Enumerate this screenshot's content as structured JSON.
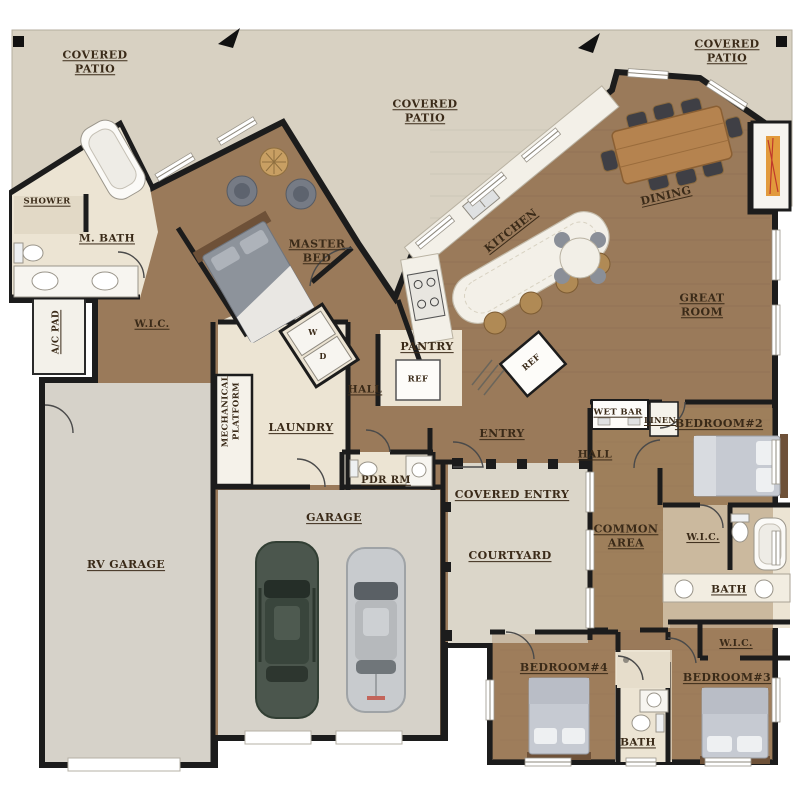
{
  "title": "Residential Floor Plan",
  "labels": {
    "covered_patio_left": "COVERED\nPATIO",
    "covered_patio_center": "COVERED\nPATIO",
    "covered_patio_right": "COVERED\nPATIO",
    "shower": "SHOWER",
    "m_bath": "M. BATH",
    "master_bed": "MASTER\nBED",
    "kitchen": "KITCHEN",
    "dining": "DINING",
    "great_room": "GREAT\nROOM",
    "ac_pad": "A/C PAD",
    "wic_master": "W.I.C.",
    "w_box": "W",
    "d_box": "D",
    "pantry": "PANTRY",
    "hall_1": "HALL",
    "ref_1": "REF",
    "ref_2": "REF",
    "mechanical_platform": "MECHANICAL\nPLATFORM",
    "laundry": "LAUNDRY",
    "entry": "ENTRY",
    "wet_bar": "WET BAR",
    "linen": "LINEN",
    "bedroom_2": "BEDROOM#2",
    "hall_2": "HALL",
    "pdr_rm": "PDR RM",
    "garage": "GARAGE",
    "covered_entry": "COVERED ENTRY",
    "courtyard": "COURTYARD",
    "common_area": "COMMON\nAREA",
    "wic_2": "W.I.C.",
    "bath_2": "BATH",
    "rv_garage": "RV GARAGE",
    "wic_3": "W.I.C.",
    "bedroom_4": "BEDROOM#4",
    "bedroom_3": "BEDROOM#3",
    "bath_3": "BATH"
  },
  "colors": {
    "wall": "#1c1c1c",
    "wood_floor": "#9a7a5a",
    "wood_light": "#a5845e",
    "tile_floor": "#ece4d3",
    "patio": "#d8d1c2",
    "concrete": "#d6d2c9",
    "courtyard": "#dbd6c9",
    "label_text": "#3a2a18",
    "marble": "#f3f0e8",
    "car_green": "#4b564d",
    "car_silver": "#c8cbce",
    "fire_accent": "#e29a3c"
  }
}
